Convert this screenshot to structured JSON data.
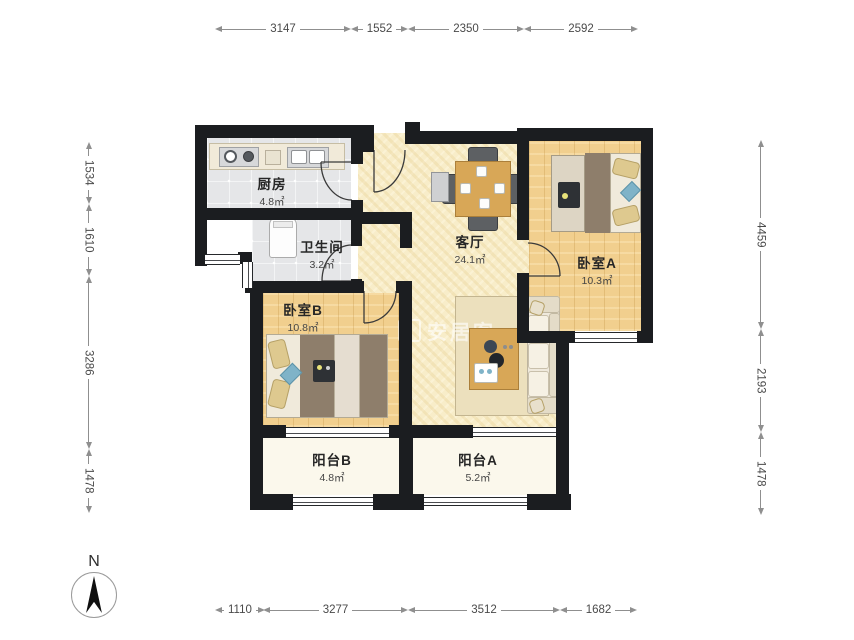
{
  "title": "两室两厅户型图",
  "rooms": {
    "kitchen": {
      "name": "厨房",
      "area": "4.8㎡"
    },
    "bathroom": {
      "name": "卫生间",
      "area": "3.2㎡"
    },
    "living": {
      "name": "客厅",
      "area": "24.1㎡"
    },
    "bedroom_a": {
      "name": "卧室A",
      "area": "10.3㎡"
    },
    "bedroom_b": {
      "name": "卧室B",
      "area": "10.8㎡"
    },
    "balcony_b": {
      "name": "阳台B",
      "area": "4.8㎡"
    },
    "balcony_a": {
      "name": "阳台A",
      "area": "5.2㎡"
    }
  },
  "dimensions": {
    "top": [
      "3147",
      "1552",
      "2350",
      "2592"
    ],
    "bottom": [
      "1110",
      "3277",
      "3512",
      "1682"
    ],
    "left": [
      "1534",
      "1610",
      "3286",
      "1478"
    ],
    "right": [
      "4459",
      "2193",
      "1478"
    ]
  },
  "compass": {
    "label": "N"
  },
  "watermark": {
    "text": "安居客"
  },
  "colors": {
    "wall": "#1b1d20",
    "living_floor": "#f8edc9",
    "wood_floor": "#f1cf8e",
    "tile_floor": "#e5e6e8",
    "balcony_floor": "#fbf8ec",
    "furniture_wood": "#d8a757",
    "dimension_text": "#4a4a4a"
  }
}
